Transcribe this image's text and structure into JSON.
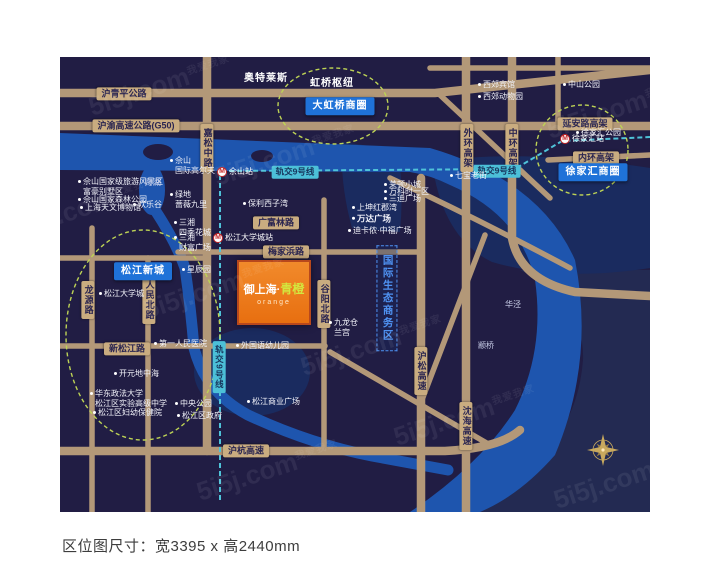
{
  "caption": {
    "text": "区位图尺寸：宽3395 x 高2440mm"
  },
  "map": {
    "colors": {
      "background": "#211d44",
      "river": "#1e55ae",
      "district_shade": "#1a2b5f",
      "road": "#b39878",
      "road_tag": "#c9ac80",
      "metro_line": "#4fc3d9",
      "district_badge": "#1f72d8",
      "highlight_dash": "#bdd355",
      "zone_blue": "#4f92f2",
      "project_orange": "#e8740f",
      "compass_gold": "#c8a95e"
    },
    "project": {
      "prefix": "御上海",
      "separator": "·",
      "accent": "青橙",
      "subtitle": "orange"
    },
    "watermark": {
      "brand": "5i5j.com",
      "company": "我爱我家",
      "positions": [
        {
          "x": 160,
          "y": 85
        },
        {
          "x": 285,
          "y": 155
        },
        {
          "x": 618,
          "y": 108
        },
        {
          "x": 85,
          "y": 207
        },
        {
          "x": 215,
          "y": 288
        },
        {
          "x": 372,
          "y": 345
        },
        {
          "x": 465,
          "y": 415
        },
        {
          "x": 268,
          "y": 470
        },
        {
          "x": 625,
          "y": 478
        }
      ]
    },
    "labels": [
      {
        "type": "road-tag",
        "text": "沪青平公路",
        "x": 124,
        "y": 94
      },
      {
        "type": "road-tag",
        "text": "沪渝高速公路(G50)",
        "x": 136,
        "y": 126
      },
      {
        "type": "road-tag",
        "text": "广富林路",
        "x": 276,
        "y": 223
      },
      {
        "type": "road-tag",
        "text": "梅家浜路",
        "x": 286,
        "y": 252
      },
      {
        "type": "road-tag",
        "text": "新松江路",
        "x": 127,
        "y": 349
      },
      {
        "type": "road-tag",
        "text": "沪杭高速",
        "x": 246,
        "y": 451
      },
      {
        "type": "road-tag",
        "text": "延安路高架",
        "x": 585,
        "y": 124
      },
      {
        "type": "road-tag",
        "text": "内环高架",
        "x": 596,
        "y": 158
      },
      {
        "type": "road-tag-v",
        "text": "嘉松中路",
        "x": 207,
        "y": 148
      },
      {
        "type": "road-tag-v",
        "text": "谷阳北路",
        "x": 324,
        "y": 304
      },
      {
        "type": "road-tag-v",
        "text": "沪松高速",
        "x": 421,
        "y": 371
      },
      {
        "type": "road-tag-v",
        "text": "外环高架",
        "x": 467,
        "y": 148
      },
      {
        "type": "road-tag-v",
        "text": "中环高架",
        "x": 512,
        "y": 148
      },
      {
        "type": "road-tag-v",
        "text": "沈海高速",
        "x": 466,
        "y": 426
      },
      {
        "type": "road-tag-v",
        "text": "龙源路",
        "x": 88,
        "y": 300
      },
      {
        "type": "road-tag-v",
        "text": "人民北路",
        "x": 149,
        "y": 300
      },
      {
        "type": "metro-tag",
        "text": "轨交9号线",
        "x": 295,
        "y": 172
      },
      {
        "type": "metro-tag",
        "text": "轨交9号线",
        "x": 497,
        "y": 171
      },
      {
        "type": "metro-tag-v",
        "text": "轨交9号线",
        "x": 219,
        "y": 367
      },
      {
        "type": "blue-box",
        "text": "大虹桥商圈",
        "x": 340,
        "y": 106
      },
      {
        "type": "blue-box",
        "text": "徐家汇商圈",
        "x": 593,
        "y": 172
      },
      {
        "type": "blue-box",
        "text": "松江新城",
        "x": 143,
        "y": 271
      },
      {
        "type": "zone-v",
        "text": "国际生态商务区",
        "x": 387,
        "y": 298
      },
      {
        "type": "area-bold",
        "text": "奥特莱斯",
        "x": 266,
        "y": 79
      },
      {
        "type": "area-bold",
        "text": "虹桥枢纽",
        "x": 332,
        "y": 84
      },
      {
        "type": "poi",
        "bullet": true,
        "anchor": "left",
        "text": "西郊宾馆",
        "x": 478,
        "y": 85
      },
      {
        "type": "poi",
        "bullet": true,
        "anchor": "left",
        "text": "西郊动物园",
        "x": 478,
        "y": 97
      },
      {
        "type": "poi",
        "bullet": true,
        "anchor": "left",
        "text": "中山公园",
        "x": 563,
        "y": 85
      },
      {
        "type": "poi",
        "bullet": true,
        "anchor": "left",
        "text": "徐家汇公园",
        "x": 576,
        "y": 133
      },
      {
        "type": "poi",
        "bullet": true,
        "anchor": "left",
        "text": "佘山\n国际高尔夫",
        "x": 170,
        "y": 166
      },
      {
        "type": "poi",
        "bullet": true,
        "anchor": "left",
        "text": "保利西子湾",
        "x": 243,
        "y": 204
      },
      {
        "type": "poi",
        "bullet": true,
        "anchor": "left",
        "text": "绿地\n蔷薇九里",
        "x": 170,
        "y": 200
      },
      {
        "type": "poi",
        "bullet": true,
        "anchor": "left",
        "text": "欢乐谷",
        "x": 133,
        "y": 205
      },
      {
        "type": "poi",
        "bullet": true,
        "anchor": "left",
        "text": "佘山国家级旅游风景区\n富豪别墅区",
        "x": 78,
        "y": 187
      },
      {
        "type": "poi",
        "bullet": true,
        "anchor": "left",
        "text": "佘山国家森林公园",
        "x": 78,
        "y": 200
      },
      {
        "type": "poi",
        "bullet": true,
        "anchor": "left",
        "text": "上海天文博物馆",
        "x": 80,
        "y": 208
      },
      {
        "type": "poi",
        "bullet": true,
        "anchor": "left",
        "text": "三湘\n四季花城",
        "x": 174,
        "y": 228
      },
      {
        "type": "poi",
        "bullet": true,
        "anchor": "left",
        "text": "三湘\n财富广场",
        "x": 174,
        "y": 243
      },
      {
        "type": "poi",
        "bullet": true,
        "anchor": "left",
        "text": "星辰园",
        "x": 182,
        "y": 270
      },
      {
        "type": "poi",
        "bullet": true,
        "anchor": "left",
        "text": "松江大学城",
        "x": 99,
        "y": 294
      },
      {
        "type": "poi",
        "bullet": true,
        "anchor": "left",
        "text": "莱顿小城",
        "x": 384,
        "y": 185
      },
      {
        "type": "poi",
        "bullet": true,
        "anchor": "left",
        "text": "万科时一区",
        "x": 384,
        "y": 192
      },
      {
        "type": "poi",
        "bullet": true,
        "anchor": "left",
        "text": "三迪广场",
        "x": 384,
        "y": 199
      },
      {
        "type": "poi",
        "bullet": true,
        "anchor": "left",
        "text": "七宝老街",
        "x": 450,
        "y": 176
      },
      {
        "type": "poi",
        "bullet": true,
        "anchor": "left",
        "text": "上坤红郡湾",
        "x": 352,
        "y": 208
      },
      {
        "type": "poi",
        "bullet": true,
        "anchor": "left",
        "bold": true,
        "text": "万达广场",
        "x": 352,
        "y": 219
      },
      {
        "type": "poi",
        "bullet": true,
        "anchor": "left",
        "text": "迪卡侬·中福广场",
        "x": 348,
        "y": 231
      },
      {
        "type": "poi",
        "bullet": true,
        "anchor": "left",
        "text": "九龙仓\n兰宫",
        "x": 329,
        "y": 328
      },
      {
        "type": "poi",
        "bullet": true,
        "anchor": "left",
        "text": "外国语幼儿园",
        "x": 236,
        "y": 346
      },
      {
        "type": "poi",
        "bullet": true,
        "anchor": "left",
        "text": "第一人民医院",
        "x": 154,
        "y": 344
      },
      {
        "type": "poi",
        "bullet": true,
        "anchor": "left",
        "text": "开元地中海",
        "x": 114,
        "y": 374
      },
      {
        "type": "poi",
        "bullet": true,
        "anchor": "left",
        "text": "华东政法大学\n松江区实验高级中学",
        "x": 90,
        "y": 399
      },
      {
        "type": "poi",
        "bullet": true,
        "anchor": "left",
        "text": "松江区妇幼保健院",
        "x": 93,
        "y": 413
      },
      {
        "type": "poi",
        "bullet": true,
        "anchor": "left",
        "text": "中央公园",
        "x": 175,
        "y": 404
      },
      {
        "type": "poi",
        "bullet": true,
        "anchor": "left",
        "text": "松江区政府",
        "x": 177,
        "y": 416
      },
      {
        "type": "poi",
        "bullet": true,
        "anchor": "left",
        "text": "松江商业广场",
        "x": 247,
        "y": 402
      },
      {
        "type": "place",
        "text": "月湖",
        "x": 153,
        "y": 183
      },
      {
        "type": "place",
        "text": "华泾",
        "x": 513,
        "y": 305
      },
      {
        "type": "place",
        "text": "颛桥",
        "x": 486,
        "y": 346
      },
      {
        "type": "metro-station",
        "text": "佘山站",
        "x": 222,
        "y": 172
      },
      {
        "type": "metro-station",
        "text": "松江大学城站",
        "x": 218,
        "y": 238
      },
      {
        "type": "metro-station",
        "text": "徐家汇站",
        "x": 565,
        "y": 139
      }
    ]
  }
}
